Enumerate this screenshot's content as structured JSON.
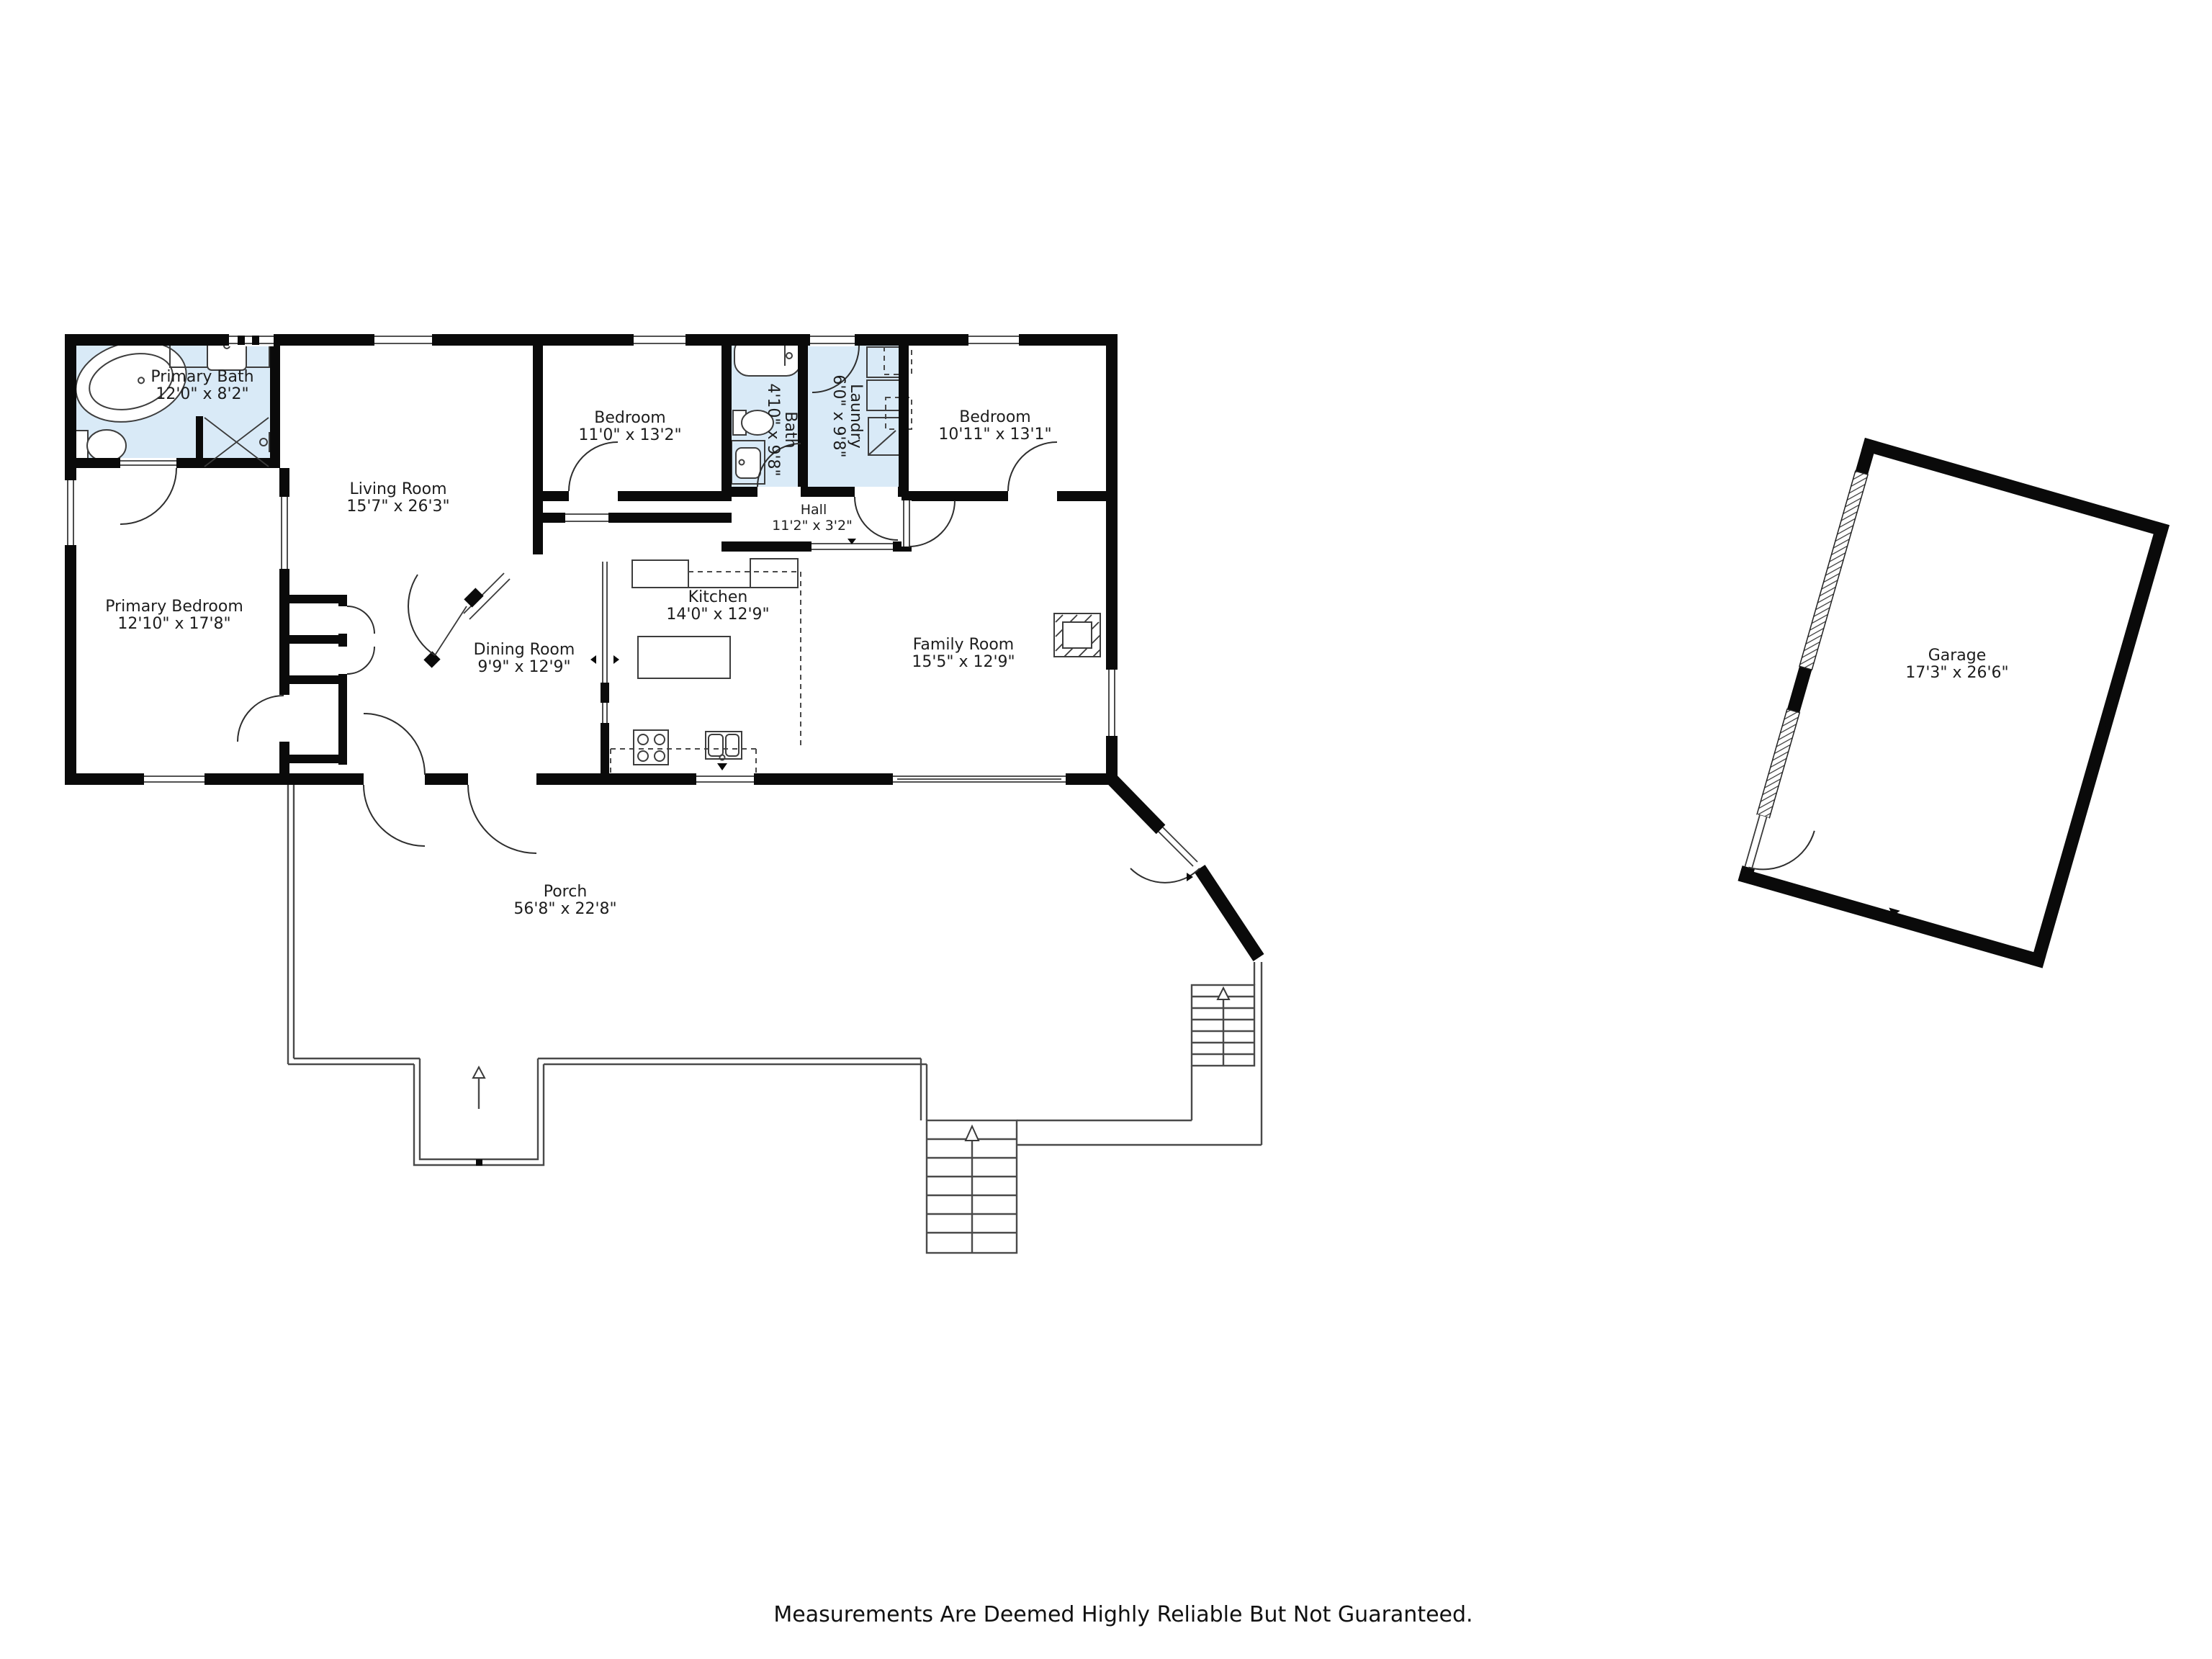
{
  "footer": {
    "disclaimer": "Measurements Are Deemed Highly Reliable But Not Guaranteed."
  },
  "rooms": [
    {
      "id": "primary-bath",
      "name": "Primary Bath",
      "dims": "12'0\" x 8'2\""
    },
    {
      "id": "living-room",
      "name": "Living Room",
      "dims": "15'7\" x 26'3\""
    },
    {
      "id": "bedroom-top",
      "name": "Bedroom",
      "dims": "11'0\" x 13'2\""
    },
    {
      "id": "bath",
      "name": "Bath",
      "dims": "4'10\" x 9'8\""
    },
    {
      "id": "laundry",
      "name": "Laundry",
      "dims": "6'0\" x 9'8\""
    },
    {
      "id": "bedroom-right",
      "name": "Bedroom",
      "dims": "10'11\" x 13'1\""
    },
    {
      "id": "hall",
      "name": "Hall",
      "dims": "11'2\" x 3'2\""
    },
    {
      "id": "primary-bedroom",
      "name": "Primary Bedroom",
      "dims": "12'10\" x 17'8\""
    },
    {
      "id": "dining-room",
      "name": "Dining Room",
      "dims": "9'9\" x 12'9\""
    },
    {
      "id": "kitchen",
      "name": "Kitchen",
      "dims": "14'0\" x 12'9\""
    },
    {
      "id": "family-room",
      "name": "Family Room",
      "dims": "15'5\" x 12'9\""
    },
    {
      "id": "porch",
      "name": "Porch",
      "dims": "56'8\" x 22'8\""
    },
    {
      "id": "garage",
      "name": "Garage",
      "dims": "17'3\" x 26'6\""
    }
  ],
  "colors": {
    "wall": "#0a0a0a",
    "bath_fill": "#d9eaf7",
    "line": "#3a3a3a"
  }
}
